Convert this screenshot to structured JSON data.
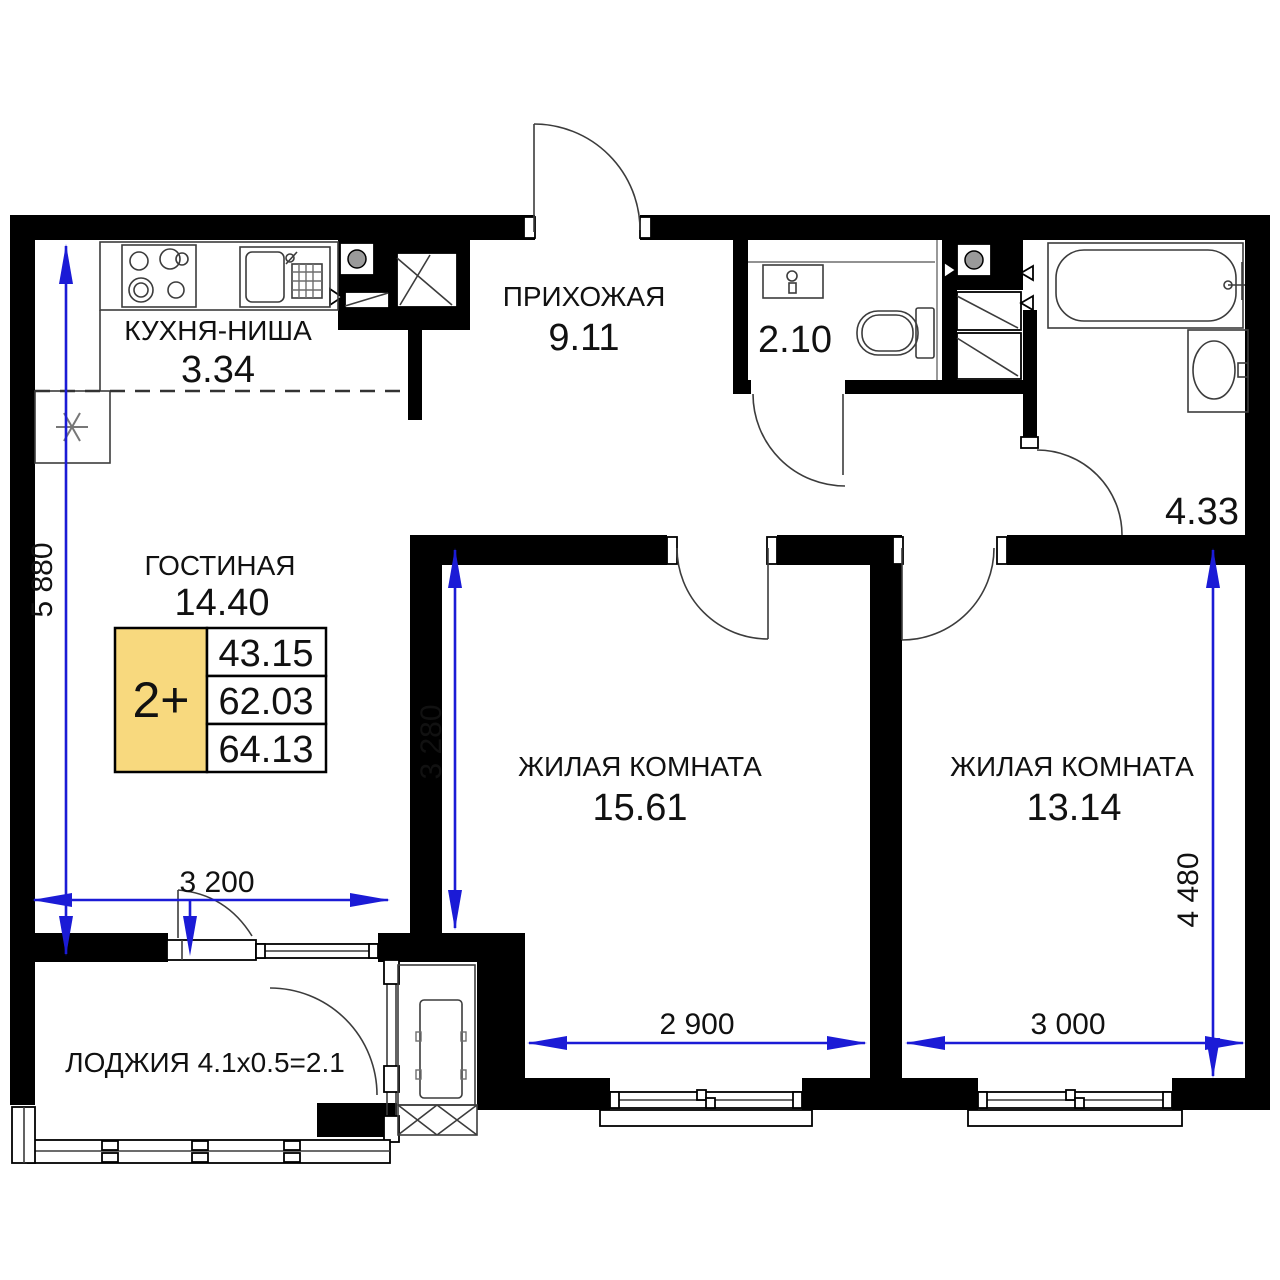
{
  "plan": {
    "rooms": {
      "kitchen": {
        "name": "КУХНЯ-НИША",
        "area": "3.34"
      },
      "hallway": {
        "name": "ПРИХОЖАЯ",
        "area": "9.11"
      },
      "wc": {
        "area": "2.10"
      },
      "bathroom": {
        "area": "4.33"
      },
      "living": {
        "name": "ГОСТИНАЯ",
        "area": "14.40"
      },
      "bedroom1": {
        "name": "ЖИЛАЯ КОМНАТА",
        "area": "15.61"
      },
      "bedroom2": {
        "name": "ЖИЛАЯ КОМНАТА",
        "area": "13.14"
      },
      "loggia": {
        "name": "ЛОДЖИЯ 4.1x0.5=2.1"
      }
    },
    "badge": {
      "layout": "2+",
      "living_area": "43.15",
      "area_without_loggia": "62.03",
      "total_area": "64.13"
    },
    "dimensions": {
      "v_left": "5 880",
      "v_room1": "3 280",
      "v_right": "4 480",
      "h_loggia": "3 200",
      "h_room1": "2 900",
      "h_room2": "3 000"
    },
    "colors": {
      "dimension_blue": "#1b1bd6",
      "badge_yellow": "#f8d97e",
      "wall_black": "#000000"
    },
    "icons": [
      "stove-icon",
      "kitchen-sink-icon",
      "fridge-snowflake-icon",
      "vent-icon",
      "toilet-icon",
      "washbasin-icon",
      "bathtub-icon",
      "ac-unit-icon"
    ]
  }
}
